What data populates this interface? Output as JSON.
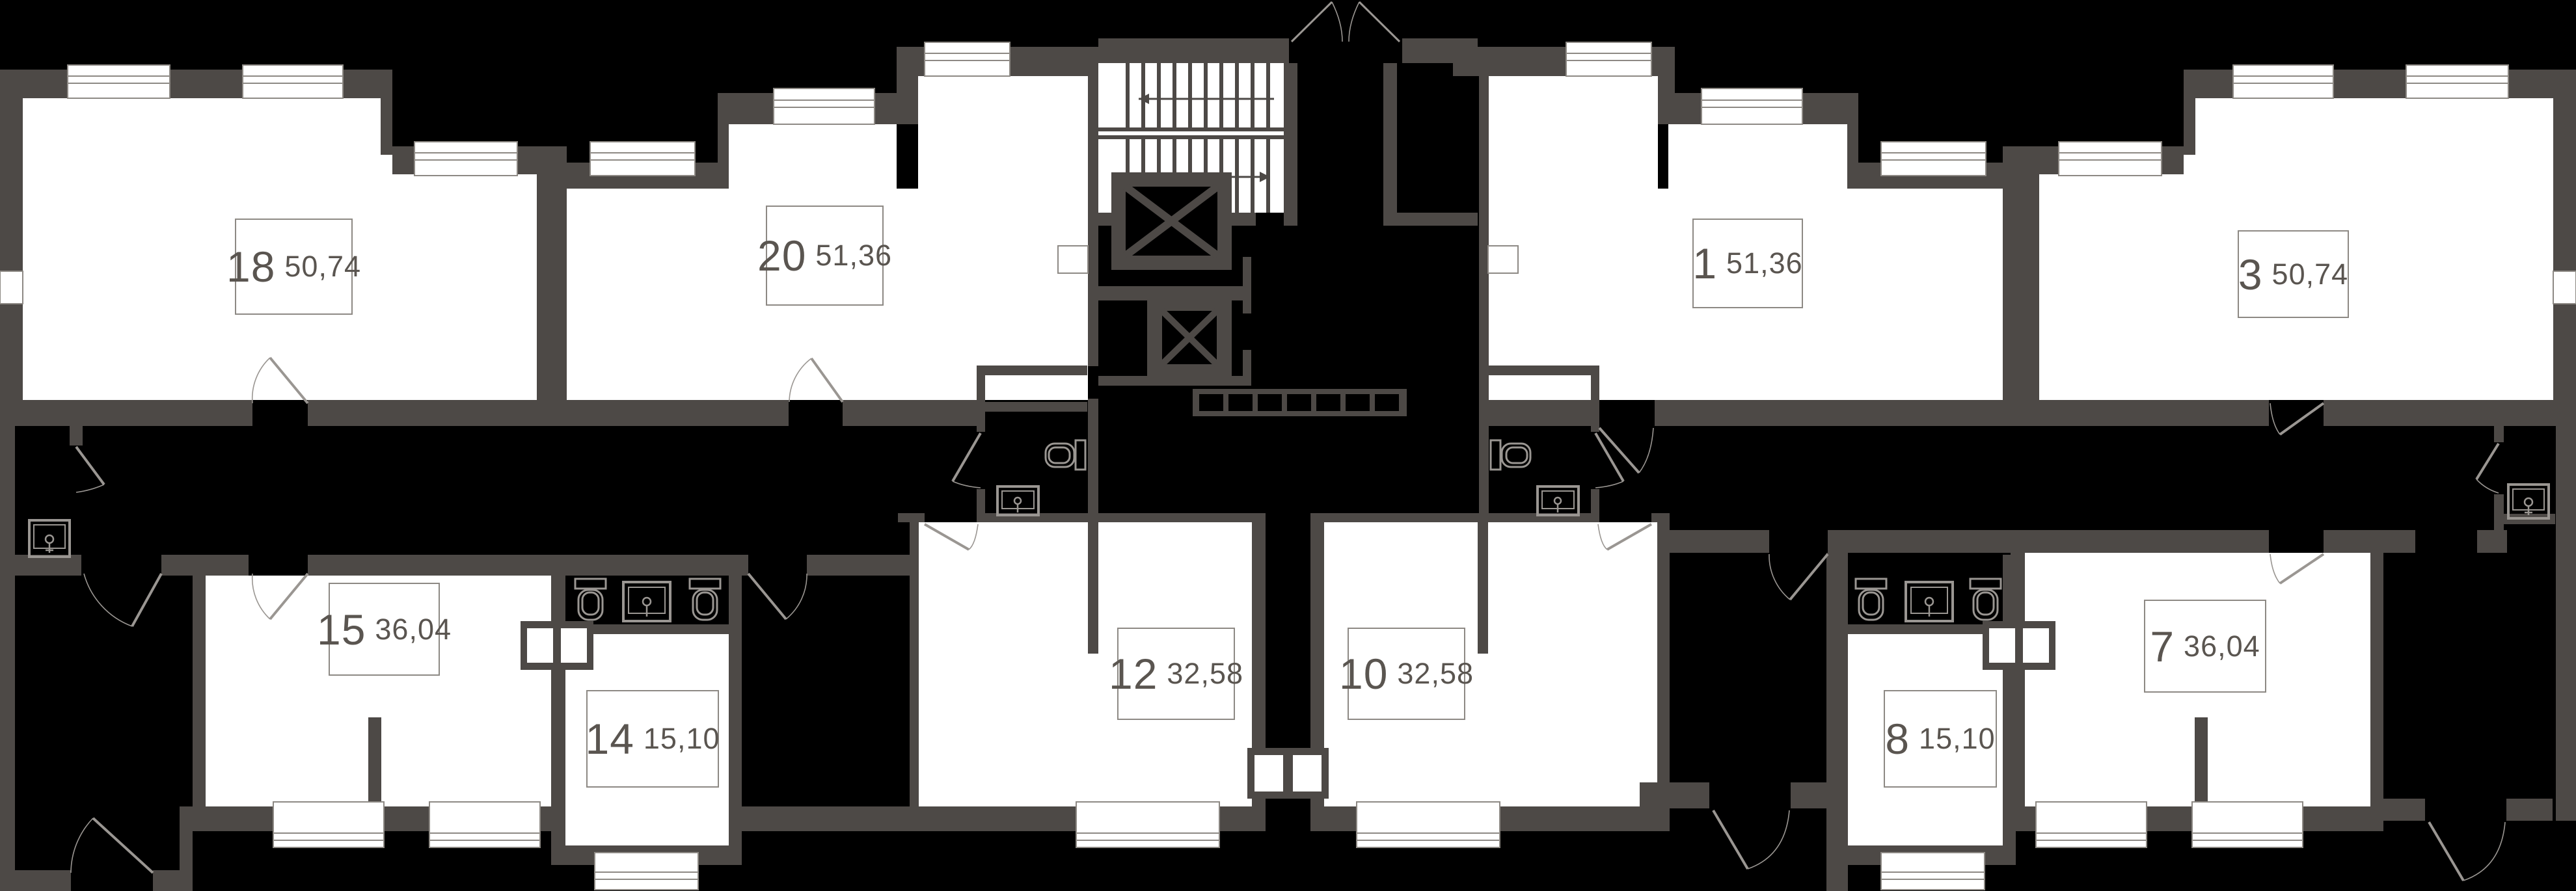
{
  "plan": {
    "kind": "residential floor plan",
    "floor_elements": [
      "staircase",
      "elevators",
      "corridor",
      "entrance doors",
      "windows",
      "bathrooms"
    ]
  },
  "colors": {
    "background": "#000000",
    "wall": "#4d4946",
    "room": "#ffffff",
    "thin_line": "#8d8984",
    "label_text": "#5a5550",
    "label_border": "#8d8984"
  },
  "apartments": [
    {
      "number": "18",
      "area": "50,74"
    },
    {
      "number": "20",
      "area": "51,36"
    },
    {
      "number": "1",
      "area": "51,36"
    },
    {
      "number": "3",
      "area": "50,74"
    },
    {
      "number": "15",
      "area": "36,04"
    },
    {
      "number": "14",
      "area": "15,10"
    },
    {
      "number": "12",
      "area": "32,58"
    },
    {
      "number": "10",
      "area": "32,58"
    },
    {
      "number": "8",
      "area": "15,10"
    },
    {
      "number": "7",
      "area": "36,04"
    }
  ],
  "core": {
    "elevators": 2,
    "stair_flights": 2,
    "duct_cells": 7
  },
  "fixtures": {
    "toilets": 6,
    "sinks": 6
  }
}
